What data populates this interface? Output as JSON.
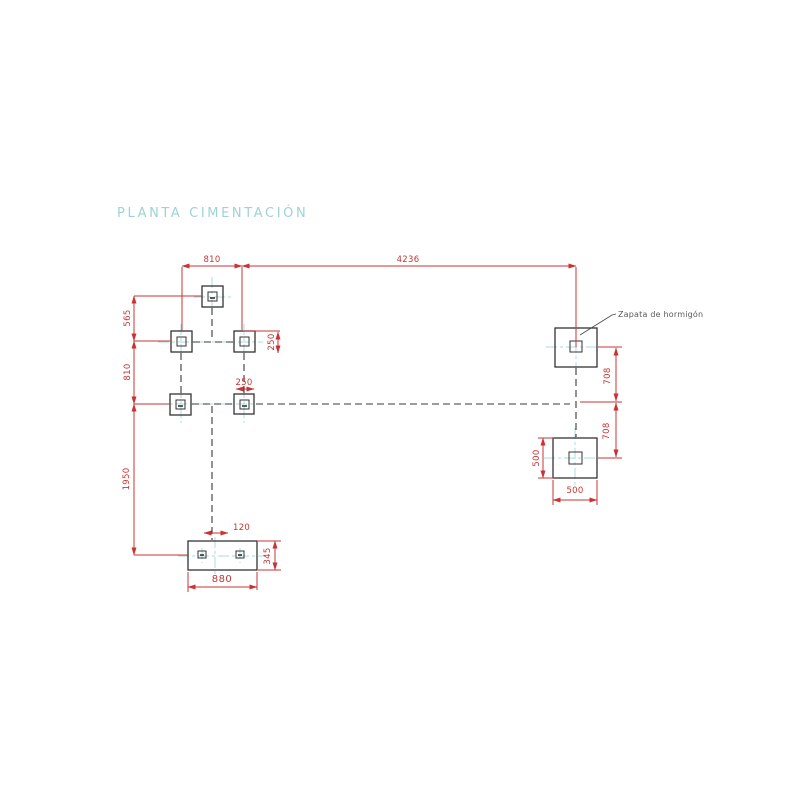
{
  "title": "PLANTA CIMENTACIÓN",
  "callout": {
    "zapata_label": "Zapata de hormigón"
  },
  "dims": {
    "top_small": "810",
    "top_large": "4236",
    "left_upper": "565",
    "left_middle": "810",
    "left_lower": "1950",
    "pillar_offset": "250",
    "pillar_width": "250",
    "right_708_upper": "708",
    "right_708_lower": "708",
    "zapata_500_vertical": "500",
    "zapata_500_horizontal": "500",
    "base_offset_120": "120",
    "base_height_345": "345",
    "base_width_880": "880"
  },
  "colors": {
    "dimension_red": "#c83434",
    "centerline_cyan": "#a9dbdf",
    "outline_dark": "#333333",
    "title_cyan": "#9fd2d6",
    "note_gray": "#5a5a5a",
    "background": "#ffffff"
  }
}
